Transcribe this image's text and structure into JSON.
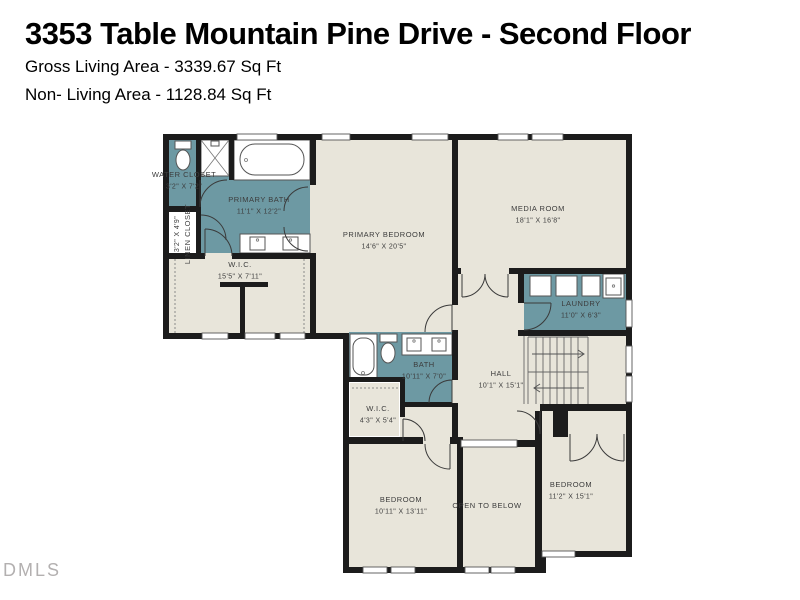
{
  "header": {
    "title": "3353 Table Mountain Pine Drive - Second Floor",
    "gross_living_area": "Gross Living Area - 3339.67 Sq Ft",
    "non_living_area": "Non- Living Area - 1128.84 Sq Ft"
  },
  "watermark": "DMLS",
  "colors": {
    "floor": "#e8e5da",
    "wet_room": "#6d99a3",
    "wall": "#1c1c1c",
    "label": "#3c3c3c"
  },
  "rooms": [
    {
      "name": "WATER CLOSET",
      "dims": "3'2\" X 7'2\"",
      "x": 184,
      "y": 177,
      "rot": 0
    },
    {
      "name": "LINEN CLOSET",
      "dims": "3'2\" X 4'9\"",
      "x": 190,
      "y": 234,
      "rot": -90
    },
    {
      "name": "PRIMARY BATH",
      "dims": "11'1\" X 12'2\"",
      "x": 259,
      "y": 202,
      "rot": 0
    },
    {
      "name": "W.I.C.",
      "dims": "15'5\" X 7'11\"",
      "x": 240,
      "y": 267,
      "rot": 0
    },
    {
      "name": "PRIMARY BEDROOM",
      "dims": "14'6\" X 20'5\"",
      "x": 384,
      "y": 237,
      "rot": 0
    },
    {
      "name": "MEDIA ROOM",
      "dims": "18'1\" X 16'8\"",
      "x": 538,
      "y": 211,
      "rot": 0
    },
    {
      "name": "LAUNDRY",
      "dims": "11'0\" X 6'3\"",
      "x": 581,
      "y": 306,
      "rot": 0
    },
    {
      "name": "BATH",
      "dims": "10'11\" X 7'0\"",
      "x": 424,
      "y": 367,
      "rot": 0
    },
    {
      "name": "HALL",
      "dims": "10'1\" X 15'1\"",
      "x": 501,
      "y": 376,
      "rot": 0
    },
    {
      "name": "W.I.C.",
      "dims": "4'3\" X 5'4\"",
      "x": 378,
      "y": 411,
      "rot": 0
    },
    {
      "name": "BEDROOM",
      "dims": "10'11\" X 13'11\"",
      "x": 401,
      "y": 502,
      "rot": 0
    },
    {
      "name": "OPEN TO BELOW",
      "dims": "",
      "x": 487,
      "y": 508,
      "rot": 0
    },
    {
      "name": "BEDROOM",
      "dims": "11'2\" X 15'1\"",
      "x": 571,
      "y": 487,
      "rot": 0
    }
  ]
}
